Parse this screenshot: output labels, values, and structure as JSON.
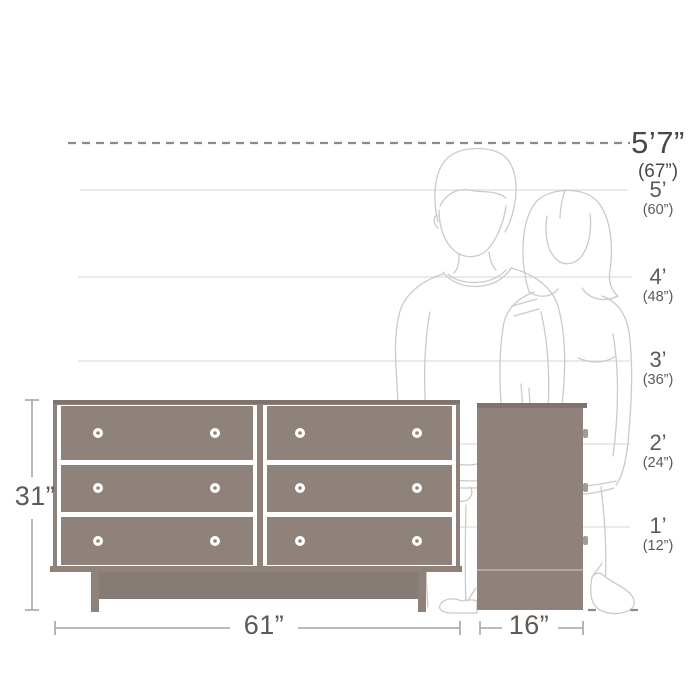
{
  "heights": [
    {
      "feet": "5’7”",
      "inches": "(67”)"
    },
    {
      "feet": "5’",
      "inches": "(60”)"
    },
    {
      "feet": "4’",
      "inches": "(48”)"
    },
    {
      "feet": "3’",
      "inches": "(36”)"
    },
    {
      "feet": "2’",
      "inches": "(24”)"
    },
    {
      "feet": "1’",
      "inches": "(12”)"
    }
  ],
  "dimensions": {
    "height": "31”",
    "width": "61”",
    "depth": "16”"
  },
  "colors": {
    "furniture": "#8e827b",
    "furniture-dark": "#7f746d",
    "furniture-plinth": "#877c75",
    "knob-side": "#a39a93",
    "figure-line": "#cccac7",
    "grid-line": "#e0deda",
    "dash-line": "#8d8a87",
    "measure-line": "#aaa49e",
    "label": "#5f5954",
    "label-strong": "#4b4744"
  }
}
